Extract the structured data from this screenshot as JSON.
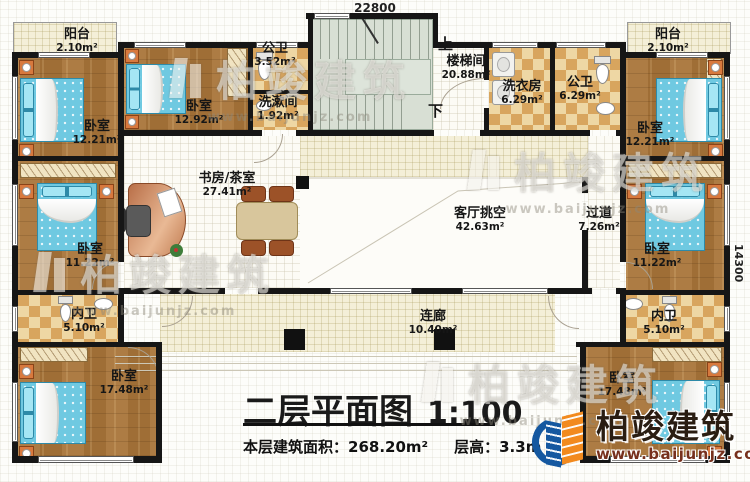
{
  "plan": {
    "dim_top": "22800",
    "dim_right": "14300",
    "stair": {
      "up": "上",
      "down": "下"
    },
    "rooms": {
      "balcony_tl": {
        "name": "阳台",
        "area": "2.10m²"
      },
      "bedroom_tl": {
        "name": "卧室",
        "area": "12.21m²"
      },
      "bedroom_t2": {
        "name": "卧室",
        "area": "12.92m²"
      },
      "bath_t": {
        "name": "公卫",
        "area": "3.52m²"
      },
      "washroom": {
        "name": "洗漱间",
        "area": "1.92m²"
      },
      "stairwell": {
        "name": "楼梯间",
        "area": "20.88m²"
      },
      "laundry": {
        "name": "洗衣房",
        "area": "6.29m²"
      },
      "bath_tr": {
        "name": "公卫",
        "area": "6.29m²"
      },
      "balcony_tr": {
        "name": "阳台",
        "area": "2.10m²"
      },
      "bedroom_tr": {
        "name": "卧室",
        "area": "12.21m²"
      },
      "study": {
        "name": "书房/茶室",
        "area": "27.41m²"
      },
      "living_void": {
        "name": "客厅挑空",
        "area": "42.63m²"
      },
      "hallway": {
        "name": "过道",
        "area": "7.26m²"
      },
      "bedroom_ml": {
        "name": "卧室",
        "area": "11.22m²"
      },
      "bedroom_mr": {
        "name": "卧室",
        "area": "11.22m²"
      },
      "ensuite_l": {
        "name": "内卫",
        "area": "5.10m²"
      },
      "ensuite_r": {
        "name": "内卫",
        "area": "5.10m²"
      },
      "bedroom_bl": {
        "name": "卧室",
        "area": "17.48m²"
      },
      "bedroom_br": {
        "name": "卧室",
        "area": "17.48m²"
      },
      "corridor": {
        "name": "连廊",
        "area": "10.40m²"
      }
    }
  },
  "title": {
    "main": "二层平面图",
    "scale": "1:100",
    "area_label": "本层建筑面积：",
    "area_value": "268.20m²",
    "height_label": "层高：",
    "height_value": "3.3m"
  },
  "brand": {
    "name": "柏竣建筑",
    "site": "www.baijunjz.com"
  },
  "watermark": {
    "text": "柏竣建筑",
    "site": "www.baijunjz.com"
  },
  "colors": {
    "wall": "#161616",
    "wood": "#a9793f",
    "tile": "#d8a55e",
    "bed": "#6fc9e1",
    "cream": "#f4efd8",
    "stair": "#d8dfd4",
    "logo_blue": "#1558a0",
    "logo_orange": "#f28a1e"
  }
}
